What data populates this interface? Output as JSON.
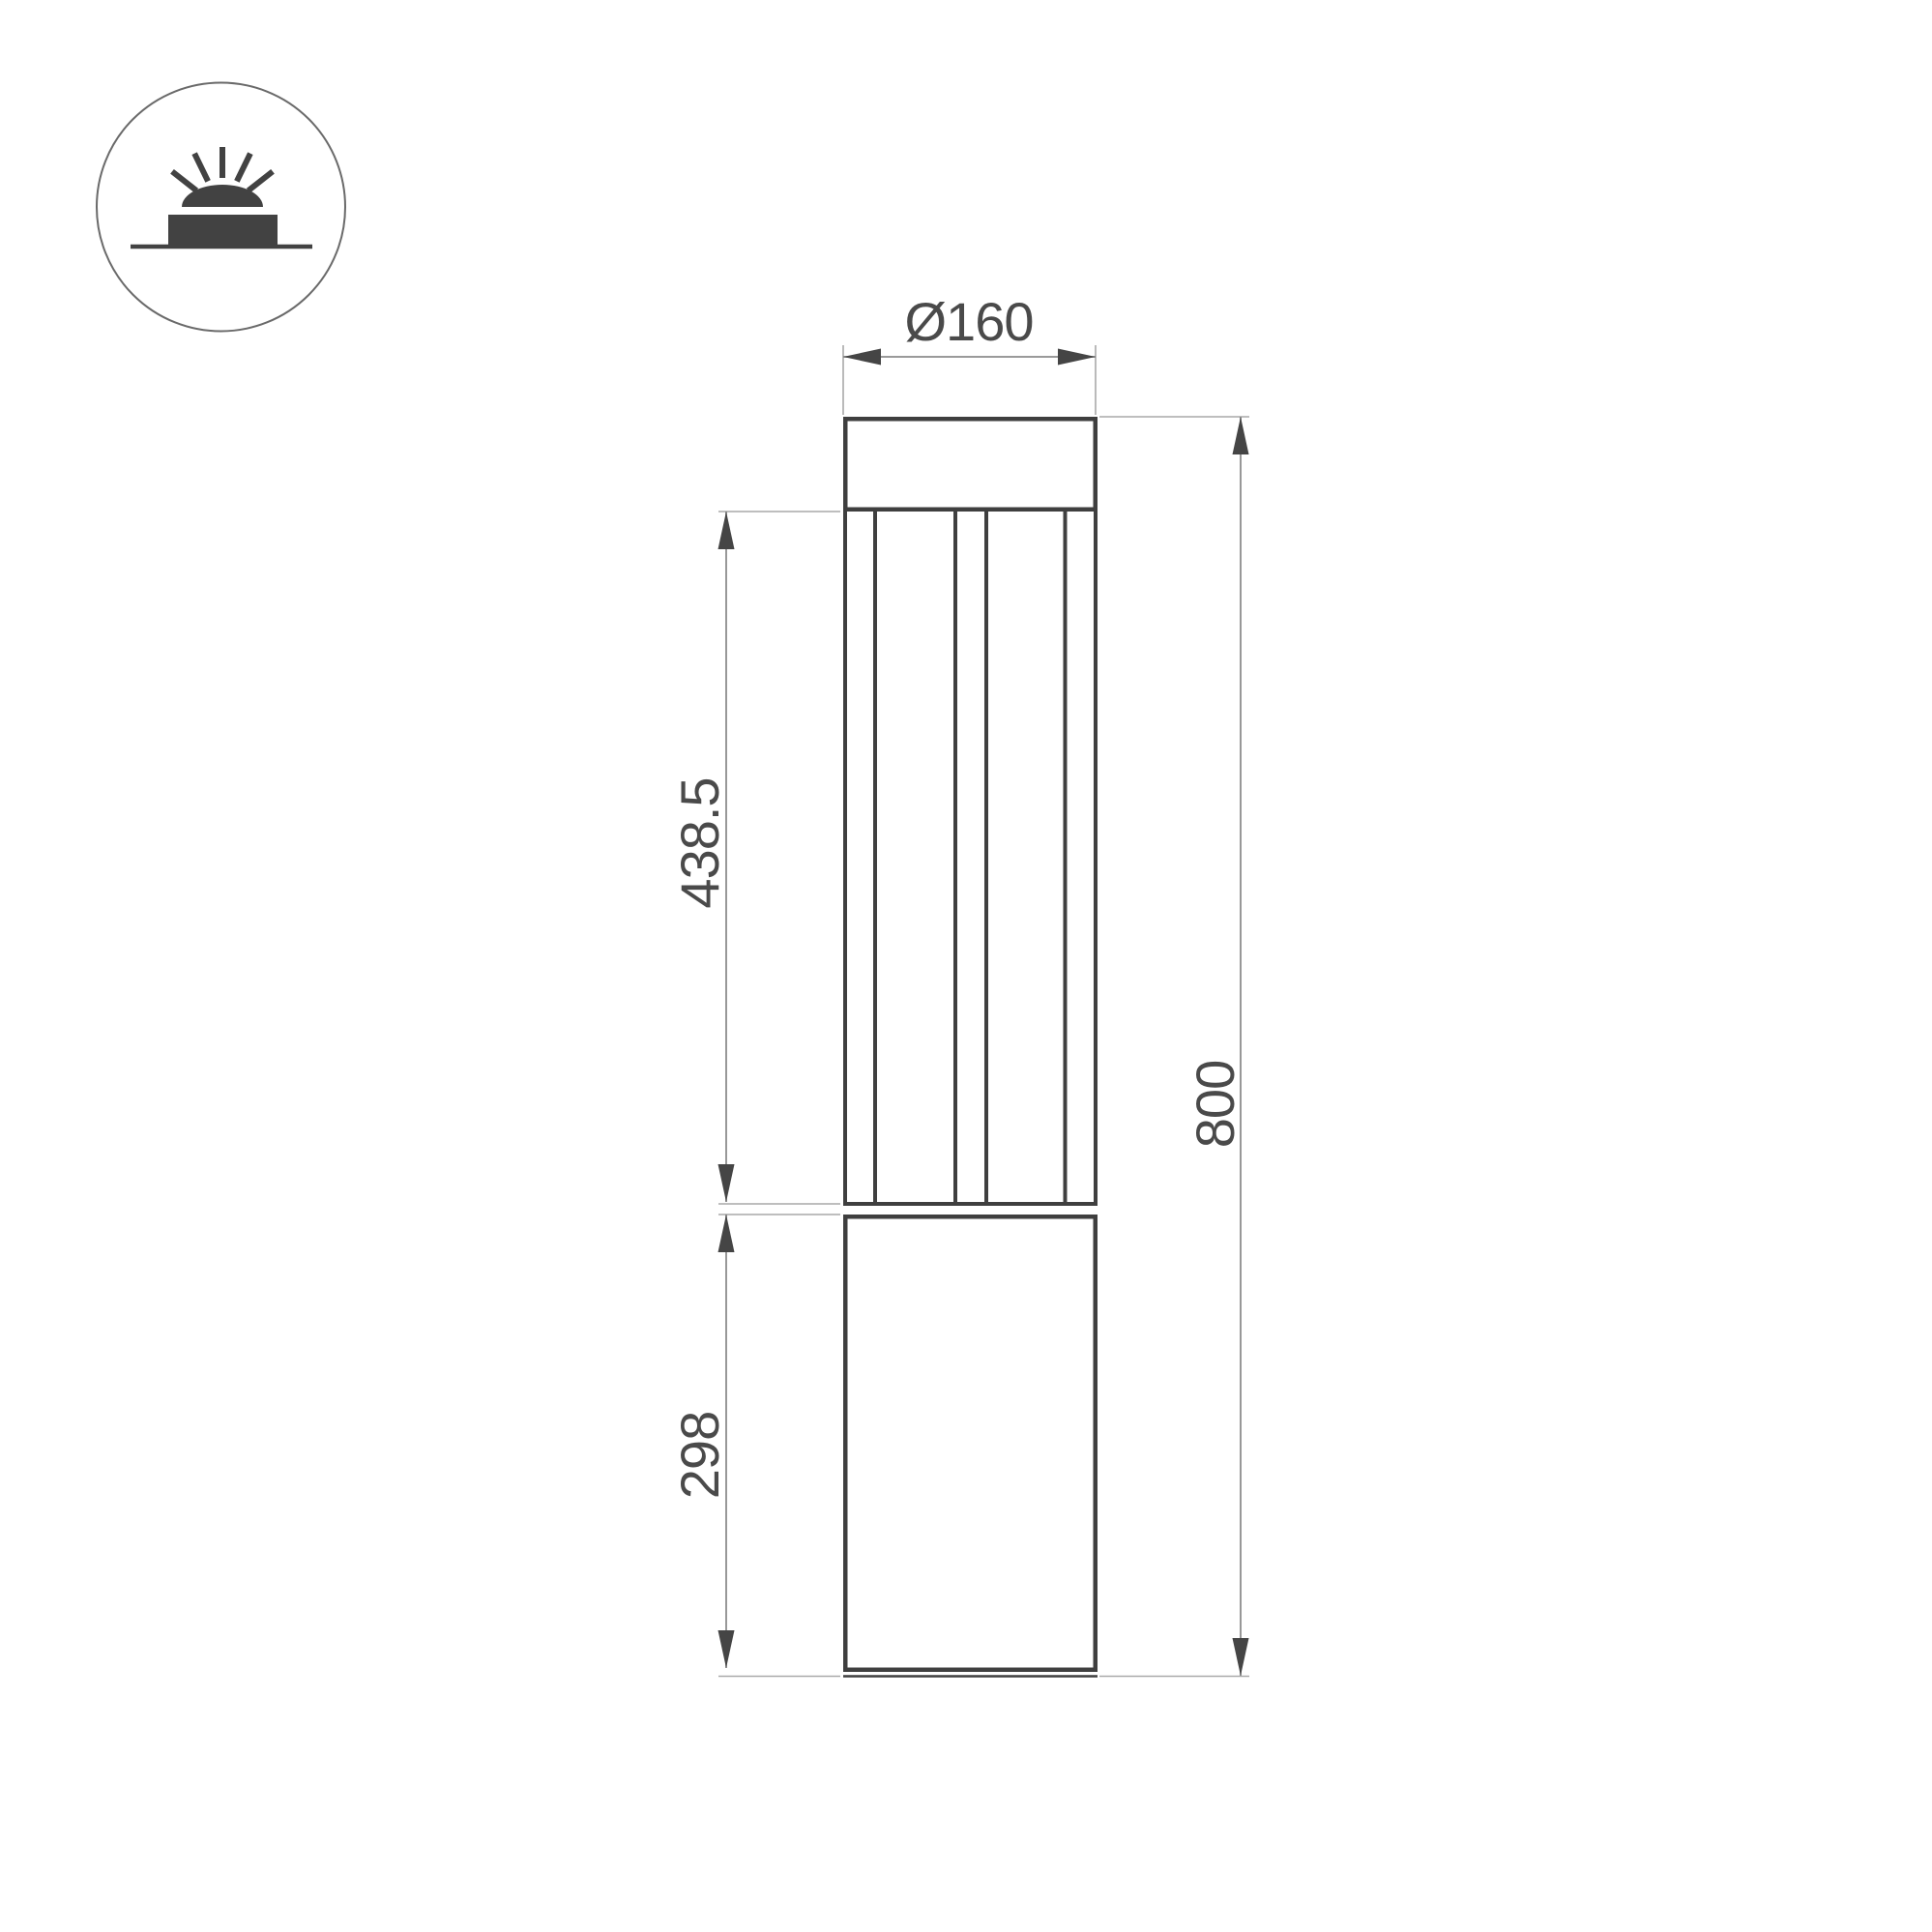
{
  "drawing": {
    "kind": "bollard-light-dimension-drawing",
    "dimensions": {
      "diameter": "Ø160",
      "lantern_height": "438.5",
      "base_height": "298",
      "total_height": "800"
    },
    "icon": {
      "name": "surface-mounted-light-icon",
      "description": "circle badge with ground-mounted dome light and rays"
    },
    "colors": {
      "outline": "#3f3f3f",
      "icon_fill": "#424242",
      "icon_circle_stroke": "#6a6a6a",
      "dimension_line": "#8c8c8c",
      "extension_line": "#a9a9a9",
      "arrow": "#454545",
      "text": "#4a4a4a",
      "background": "#ffffff"
    }
  }
}
